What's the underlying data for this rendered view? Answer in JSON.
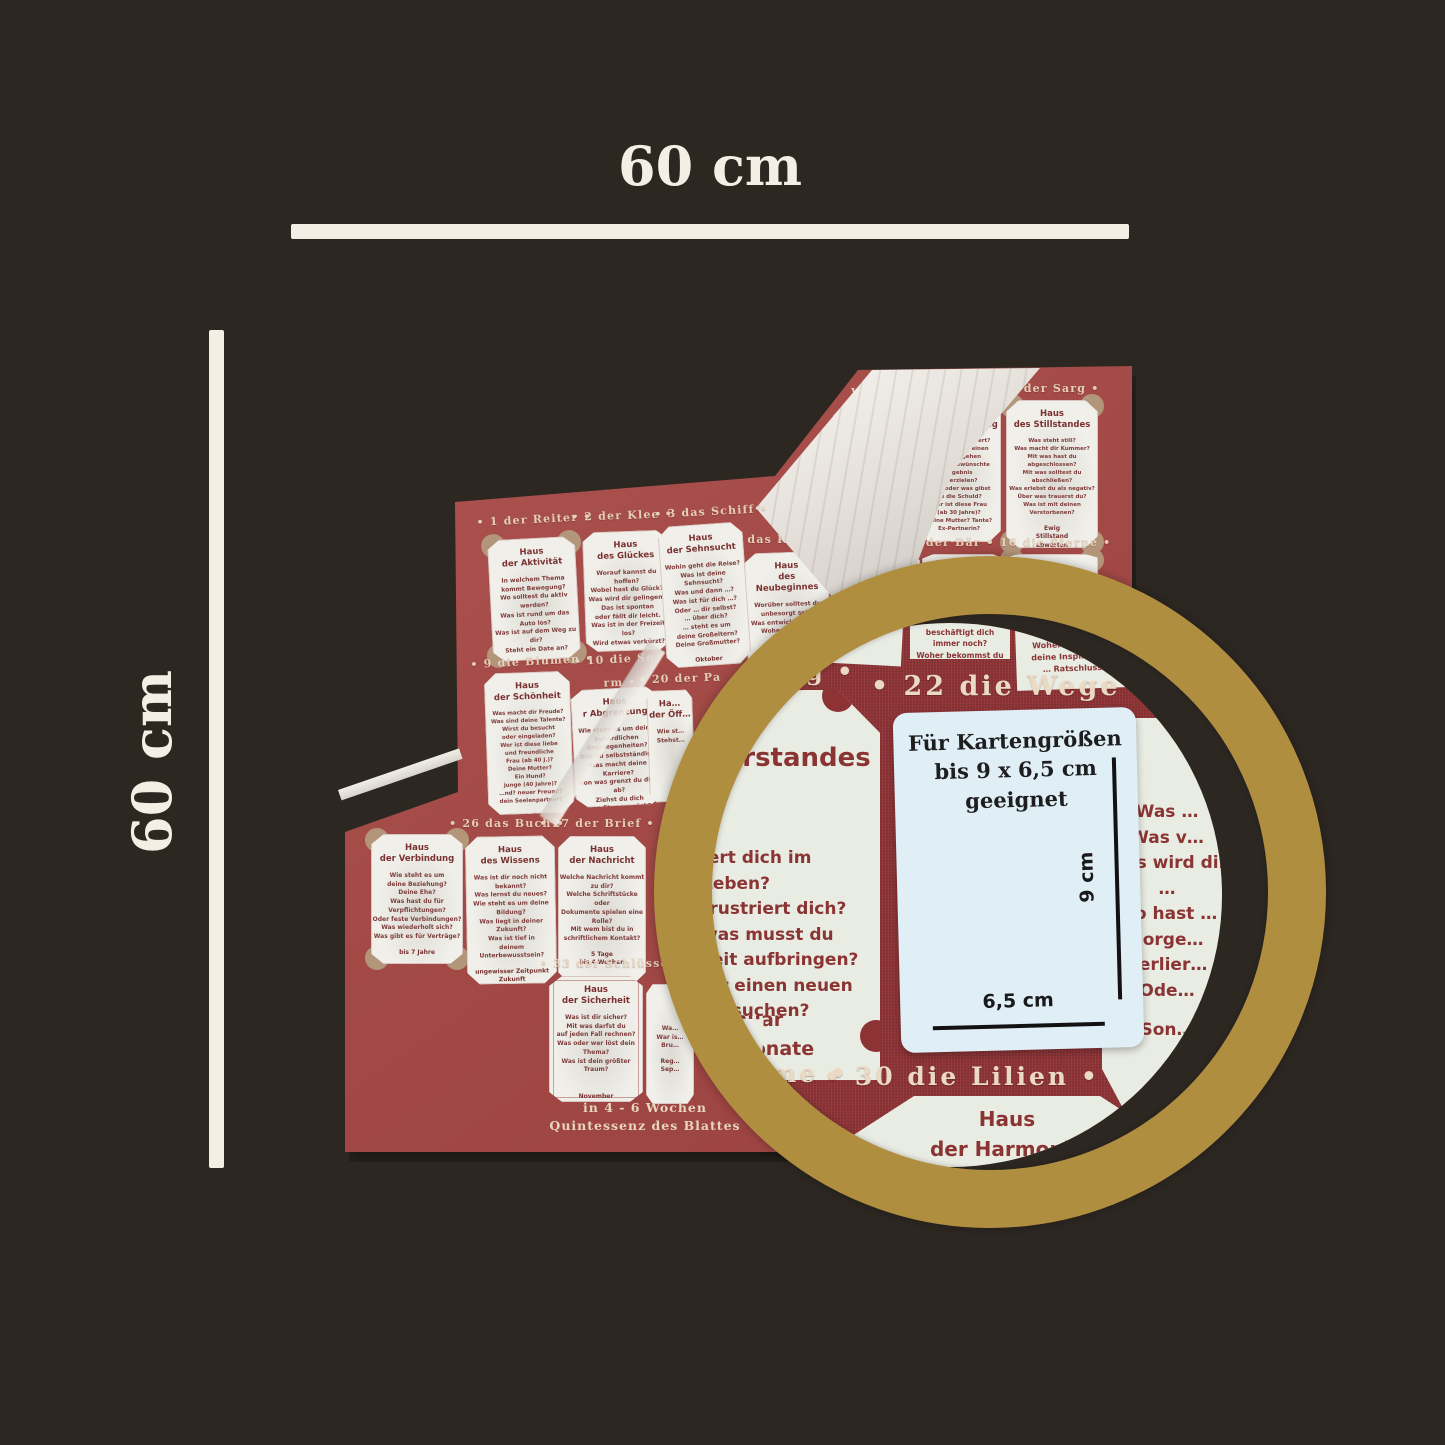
{
  "annotations": {
    "width_label": "60 cm",
    "height_label": "60 cm"
  },
  "cloth": {
    "labels": {
      "reiter": "• 1 der Reiter •",
      "klee": "• 2 der Klee •",
      "schiff": "• 3 das Schiff •",
      "haus_frag": "• 4 das",
      "wolken_frag": "Wolken •",
      "schlange": "• 7 die Schlange •",
      "sarg": "• 8 der Sarg •",
      "kind_frag": "das Kind •",
      "fuchs": "• 14 der Fuchs •",
      "baer": "• 15 der Bär •",
      "sterne": "• 16 die Sterne •",
      "blumen": "• 9 die Blumen •",
      "sense_frag": "• 10 die Se",
      "turm_frag": "rm •",
      "park_frag": "• 20 der Pa",
      "berg_frag": "Berg",
      "buch": "• 26 das Buch •",
      "brief": "• 27 der Brief •",
      "schluessel_frag": "• 33 der Schlüssel"
    },
    "cards": {
      "aktivitaet": {
        "title": [
          "Haus",
          "der Aktivität"
        ],
        "body": [
          "In welchem Thema",
          "kommt Bewegung?",
          "Wo solltest du aktiv werden?",
          "Was ist rund um das Auto los?",
          "Was ist auf dem Weg zu dir?",
          "Steht ein Date an?"
        ],
        "footer": [
          "5 - 10 Tage",
          "schnell",
          "bereits unterwegs"
        ]
      },
      "glueckes": {
        "title": [
          "Haus",
          "des Glückes"
        ],
        "body": [
          "Worauf kannst du hoffen?",
          "Wobei hast du Glück?",
          "Was wird dir gelingen?",
          "Das ist spontan",
          "oder fällt dir leicht.",
          "Was ist in der Freizeit los?",
          "Wird etwas verkürzt?"
        ],
        "footer": [
          "3 - 4 Tage",
          "verkürzt die Zeit",
          "um die Hälfte"
        ]
      },
      "sehnsucht": {
        "title": [
          "Haus",
          "der Sehnsucht"
        ],
        "body": [
          "Wohin geht die Reise?",
          "Was ist deine Sehnsucht?",
          "Was und dann …?",
          "Was ist für dich …?",
          "Oder … dir selbst?",
          "… über dich?",
          "… steht es um",
          "deine Großeltern?",
          "Deine Großmutter?"
        ],
        "footer": [
          "Oktober"
        ]
      },
      "neubeginnes": {
        "title": [
          "Haus",
          "des Neubeginnes"
        ],
        "body": [
          "Worüber solltest du",
          "unbesorgt sein?",
          "Was entwickelt sich …",
          "Woher kannst …",
          "Hast d…",
          "Was ist …"
        ]
      },
      "fuchs_card": {
        "title": [
          "Haus",
          "de…"
        ]
      },
      "unklarheit": {
        "title": [
          "Haus",
          "der Unklarheit"
        ],
        "body": [
          "…hst du Schwierigkeiten?",
          "… eine schlechte Phase",
          "in deinem Leben?",
          "…lebst du Rückschläge?",
          "Was ist dir unklar?",
          "Wer macht dir Probleme?",
          "Was ist mit dem Ex-Partner?",
          "Wer ist der",
          "schwierige Mann (ab 40 Jahre)?"
        ],
        "footer": [
          "Herbst",
          "6 Jahre"
        ]
      },
      "verwicklung": {
        "title": [
          "Haus",
          "der Verwicklung"
        ],
        "body": [
          "Was ist kompliziert?",
          "Wo musst du einen",
          "Umweg gehen",
          "um das gewünschte Ergebnis",
          "zu erzielen?",
          "Wem oder was gibst",
          "du die Schuld?",
          "Wer ist diese Frau",
          "(ab 30 Jahre)?",
          "Deine Mutter? Tante?",
          "Ex-Partnerin?"
        ],
        "footer": [
          "7 Jahre"
        ]
      },
      "stillstand": {
        "title": [
          "Haus",
          "des Stillstandes"
        ],
        "body": [
          "Was steht still?",
          "Was macht dir Kummer?",
          "Mit was hast du abgeschlossen?",
          "Mit was solltest du abschließen?",
          "Was erlebst du als negativ?",
          "Über was trauerst du?",
          "Was ist mit deinen Verstorbenen?"
        ],
        "footer": [
          "Ewig",
          "Stillstand",
          "abwarten"
        ]
      },
      "schoenheit": {
        "title": [
          "Haus",
          "der Schönheit"
        ],
        "body": [
          "Was macht dir Freude?",
          "Was sind deine Talente?",
          "Wirst du besucht",
          "oder eingeladen?",
          "Wer ist diese liebe",
          "und freundliche",
          "Frau (ab 40 J.)?",
          "Deine Mutter?",
          "Ein Hund?",
          "junge (40 Jahre)?",
          "…nd? neuer Freund?",
          "dein Seelenpartner?"
        ],
        "footer": [
          "Juli"
        ]
      },
      "abgrenzung": {
        "title": [
          "Haus",
          "r Abgrenzung"
        ],
        "body": [
          "Wie steht es um deine",
          "behördlichen Angelegenheiten?",
          "Bist du selbstständig?",
          "Was macht deine Karriere?",
          "Von was grenzt du dich ab?",
          "Ziehst du dich",
          "von Etwas zurück?"
        ],
        "footer": [
          "Frühling bis Sommer"
        ]
      },
      "oeffentlichkeit": {
        "title": [
          "Ha…",
          "der Öff…"
        ],
        "body": [
          "Wie st…",
          "Stehst…"
        ]
      },
      "widerstand_frag": {
        "title": [
          "Hau",
          "es W"
        ]
      },
      "verbindung": {
        "title": [
          "Haus",
          "der Verbindung"
        ],
        "body": [
          "Wie steht es um",
          "deine Beziehung?",
          "Deine Ehe?",
          "Was hast du für Verpflichtungen?",
          "Oder feste Verbindungen?",
          "Was wiederholt sich?",
          "Was gibt es für Verträge?"
        ],
        "footer": [
          "bis 7 Jahre"
        ]
      },
      "wissens": {
        "title": [
          "Haus",
          "des Wissens"
        ],
        "body": [
          "Was ist dir noch nicht bekannt?",
          "Was lernst du neues?",
          "Wie steht es um deine Bildung?",
          "Was liegt in deiner Zukunft?",
          "Was ist tief in",
          "deinem Unterbewusstsein?"
        ],
        "footer": [
          "ungewisser Zeitpunkt",
          "Zukunft",
          "März"
        ]
      },
      "nachricht": {
        "title": [
          "Haus",
          "der Nachricht"
        ],
        "body": [
          "Welche Nachricht kommt zu dir?",
          "Welche Schriftstücke oder",
          "Dokumente spielen eine Rolle?",
          "Mit wem bist du in",
          "schriftlichem Kontakt?"
        ],
        "footer": [
          "5 Tage",
          "bis 4 Wochen"
        ]
      },
      "sicherheit": {
        "title": [
          "Haus",
          "der Sicherheit"
        ],
        "body": [
          "Was ist dir sicher?",
          "Mit was darfst du",
          "auf jeden Fall rechnen?",
          "Was oder wer löst dein Thema?",
          "Was ist dein größter Traum?"
        ],
        "footer": [
          "November"
        ]
      },
      "fische_frag": {
        "body": [
          "Wa…",
          "War is…",
          "Bru…"
        ],
        "footer": [
          "Reg…",
          "Sep…"
        ]
      }
    },
    "bottom_note": [
      "in 4 - 6 Wochen",
      "Quintessenz des Blattes"
    ]
  },
  "magnifier": {
    "berg_heading_frag": "g •",
    "wege_heading": "• 22 die Wege •",
    "dame_frag": "Dame •",
    "lilien_heading": "• 30 die Lilien •",
    "widerstand": {
      "title": [
        "us",
        "derstandes"
      ],
      "body": [
        "iert dich im Leben?",
        "frustriert dich?",
        "was musst du",
        "zeit aufbringen?",
        "dir einen neuen",
        "eg suchen?"
      ],
      "footer": [
        "Januar",
        "3 Monate"
      ]
    },
    "right_card": {
      "body": [
        "Was …",
        "Was v…",
        "Was wird dir …",
        "Wo hast …",
        "Sorge…",
        "Verlier…",
        "Ode…"
      ],
      "footer": [
        "Son…"
      ]
    },
    "harmonie": {
      "title": [
        "Haus",
        "der Harmonie"
      ]
    },
    "top_fragments": {
      "a": [
        "…st du nochmal?",
        "…ist auf dich …",
        "Wo machst d…"
      ],
      "b": [
        "beschäftigt dich immer noch?",
        "Woher bekommst du …"
      ],
      "c": [
        "um zu …",
        "Woher bekommst",
        "deine Inspiration?",
        "… Ratschluss"
      ]
    },
    "bottom_fragments": [
      "in 6",
      "ssenz"
    ],
    "side_fragment": "Sep…",
    "demo_card": {
      "lines": [
        "Für Kartengrößen",
        "bis 9 x 6,5 cm",
        "geeignet"
      ],
      "height_label": "9 cm",
      "width_label": "6,5 cm"
    }
  },
  "colors": {
    "background": "#2d2722",
    "cream": "#f4efe4",
    "cloth_red": "#a34a47",
    "magnified_red": "#8d3336",
    "gold": "#b08e40",
    "card": "#f0efe9",
    "card_text": "#7a3030",
    "demo_card_bg": "#e0eff6"
  }
}
